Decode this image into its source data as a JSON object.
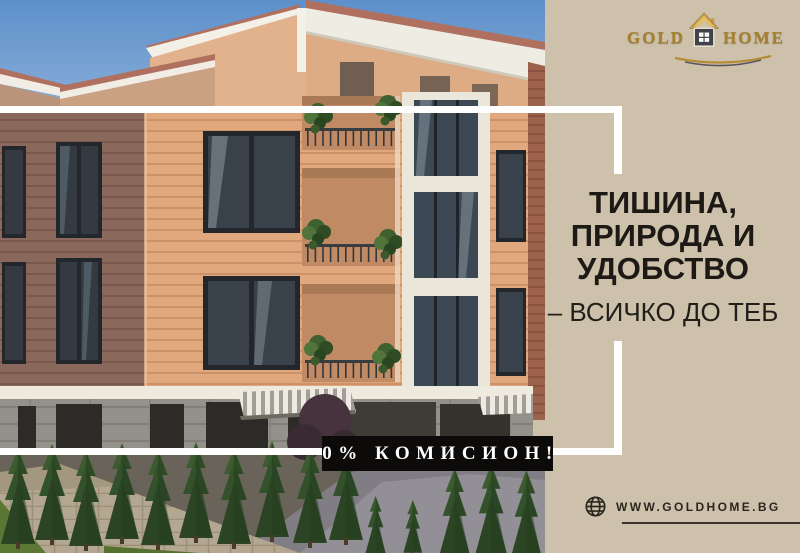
{
  "logo": {
    "word_left": "GOLD",
    "word_right": "HOME",
    "house_icon": "house-icon",
    "swoosh_icon": "swoosh-underline"
  },
  "headline": {
    "title": "ТИШИНА,\nПРИРОДА И\nУДОБСТВО",
    "subtitle": "– ВСИЧКО ДО ТЕБ"
  },
  "badge": {
    "label": "0% КОМИСИОН!"
  },
  "footer": {
    "website": "WWW.GOLDHOME.BG",
    "globe_icon": "globe-icon"
  },
  "colors": {
    "background_beige": "#cdc1ab",
    "accent_gold": "#a6802f",
    "badge_bg": "#0c0b09",
    "badge_text": "#ffffff",
    "headline_text": "#1d1a15",
    "frame_white": "#ffffff",
    "facade_lit": "#e0a87c",
    "facade_shadow": "#8a695c",
    "sky_blue": "#5d90ca"
  }
}
